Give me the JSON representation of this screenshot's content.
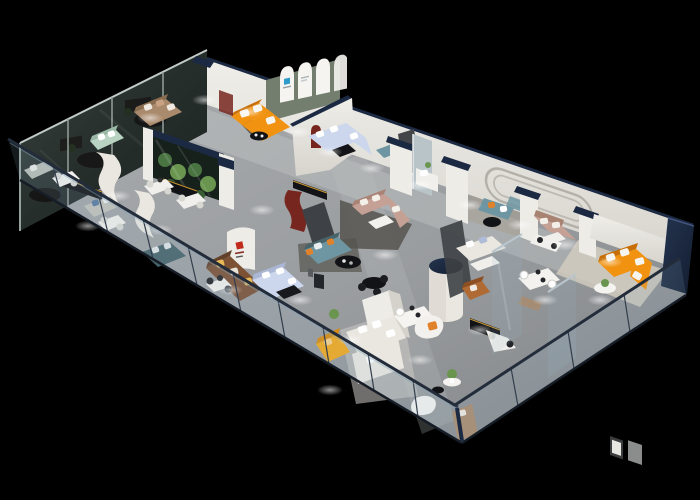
{
  "scene": {
    "title": "3D isometric cutaway floor-plan render of a furniture showroom on a black background",
    "view": "axonometric aerial cutaway, long hall running from lower-left tip to far right, glass balustrade along the near edge",
    "background": "#000000",
    "areas": [
      "tinted-glass-curtain-wall-offices (back left)",
      "open-desk-lounge-area (left tip)",
      "arched-gallery-room-with-orange-sofa (top center)",
      "lavender-sectional-living-display",
      "terrarium-plant-glass-feature-wall (center left)",
      "brand-logo-wall (center left)",
      "teal-and-blush-sofa-central-lounge",
      "meeting-booths-along-back-wall (right of center)",
      "white-column-corridor-with-navy-caps",
      "cream-sofa-and-dining-displays (front right)",
      "vip-room-with-orange-sofa-and-wall-art (far right)",
      "front-terrace-behind-glass-railing (bottom center)"
    ],
    "furniture": [
      {
        "item": "l-shaped-sofa",
        "area": "arched-gallery-room",
        "color_key": "orange"
      },
      {
        "item": "l-shaped-sofa",
        "area": "vip-room-far-right",
        "color_key": "orange"
      },
      {
        "item": "compact-sofa",
        "area": "front-terrace",
        "color_key": "amber"
      },
      {
        "item": "u-shaped-sectional",
        "area": "lavender-display",
        "color_key": "lav"
      },
      {
        "item": "sectional-sofa",
        "area": "center-left-display",
        "color_key": "lav"
      },
      {
        "item": "sofa-with-orange-pillows",
        "area": "central-lounge",
        "color_key": "teal"
      },
      {
        "item": "l-shaped-sofa",
        "area": "central-lounge",
        "color_key": "blush"
      },
      {
        "item": "leather-sofa",
        "area": "logo-wall-lounge",
        "color_key": "cocoa"
      },
      {
        "item": "sofa",
        "area": "left-wing",
        "color_key": "mint"
      },
      {
        "item": "sofa",
        "area": "back-left-room",
        "color_key": "tan"
      },
      {
        "item": "booth-benches-with-orange-pillows",
        "area": "meeting-booths",
        "color_key": "teal"
      },
      {
        "item": "l-shaped-sofa",
        "area": "right-corridor",
        "color_key": "blush"
      },
      {
        "item": "white-sectional",
        "area": "front-terrace",
        "color_key": "cream"
      },
      {
        "item": "armchairs",
        "area": "front-terrace",
        "color_key": "cream"
      },
      {
        "item": "cognac-armchair",
        "area": "front-right",
        "color_key": "cocoa"
      },
      {
        "item": "black-media-consoles-with-gold-trim",
        "area": "various",
        "color_key": "blackF"
      },
      {
        "item": "round-black-coffee-tables",
        "area": "central-lounge",
        "color_key": "blackF"
      },
      {
        "item": "white-dining-and-desk-sets",
        "area": "various",
        "color_key": "cream"
      },
      {
        "item": "potted-plants",
        "area": "various",
        "color_key": "plant2"
      },
      {
        "item": "white-cylinder-column-navy-cap",
        "area": "front-right",
        "color_key": "cream"
      }
    ],
    "architecture": {
      "wall_caps": "dark navy parapet caps on white partition walls and columns",
      "curtain_wall": "three dark tinted glass panels rising above the back-left wing",
      "terrarium": "glass vitrine wall filled with green plants, navy top rail",
      "arch_gallery": "sage-green wall with three white arched panels, small blue logo poster",
      "accents": "dark-red arched niche and curved maroon panel, red brand logo on white curved wall",
      "balustrade": "continuous clear glass railing with dark top rail along the near (bottom) edge",
      "back_wall_detail": "recessed stadium-shaped groove moulding on right back wall"
    },
    "signs": [
      {
        "name": "arch-poster-blue-logo",
        "legible": false
      },
      {
        "name": "red-brand-logo-wall",
        "legible": false
      }
    ]
  },
  "palette": {
    "bg": "#000000",
    "floor1": "#aeb1b3",
    "floor2": "#8f9294",
    "floor3": "#7c7f82",
    "aisle": "#bcbfc0",
    "rugL": "#cbc9c4",
    "rugD": "#56544f",
    "wall": "#edece7",
    "wallSh": "#d5d2cb",
    "wallEdge": "#b3b0a9",
    "navy": "#1b2942",
    "navy2": "#2a3c5e",
    "charcoal": "#434549",
    "glassD": "#2a3231",
    "glassF": "#94a09d",
    "terraD": "#17211c",
    "plant1": "#4a7342",
    "plant2": "#69954f",
    "archG": "#737e6f",
    "archW": "#f5f4f0",
    "maroon": "#77261f",
    "redL": "#c12b1e",
    "orange": "#f19210",
    "orange2": "#c76f06",
    "amber": "#f3a81a",
    "mint": "#b8d3c1",
    "lav": "#ccd7ee",
    "teal": "#6e96a2",
    "tealG": "#48646b",
    "blush": "#c5a195",
    "cocoa": "#7c5134",
    "tan": "#aa8a6c",
    "cream": "#eae7e0",
    "blackF": "#121316",
    "gold": "#c89733",
    "trav": "#d4cec1",
    "mirror": "#b9c4c8",
    "wood": "#9b8e7e",
    "railG": "rgba(150,185,205,0.14)",
    "railT": "#232c3a",
    "blueLogo": "#2e9ccb"
  }
}
